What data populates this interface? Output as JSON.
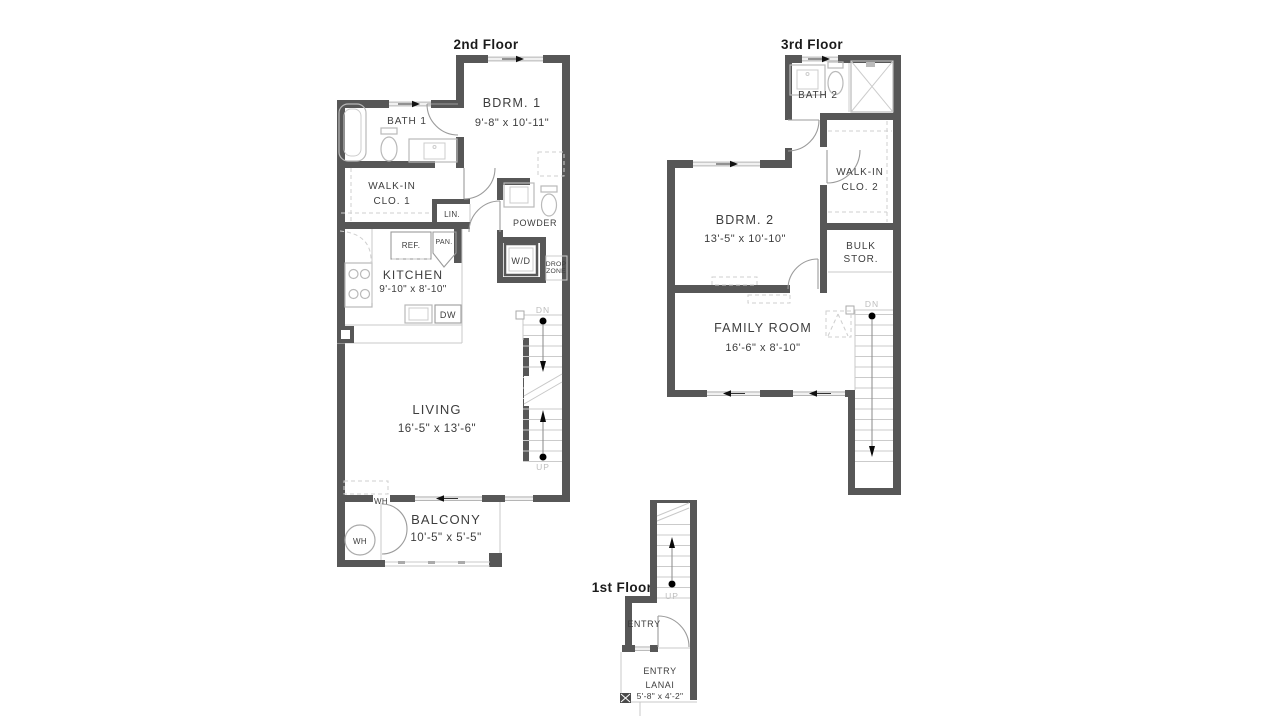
{
  "colors": {
    "wall": "#575757",
    "fixture_line": "#b9b9b9",
    "text": "#3d3d3d",
    "stair_text": "#bdbdbd"
  },
  "floors": {
    "second": {
      "title": "2nd Floor",
      "bdrm1": {
        "name": "BDRM. 1",
        "dims": "9'-8\" x 10'-11\""
      },
      "bath1": {
        "name": "BATH 1"
      },
      "walkin1": {
        "line1": "WALK-IN",
        "line2": "CLO. 1"
      },
      "lin": {
        "name": "LIN."
      },
      "powder": {
        "name": "POWDER"
      },
      "ref": {
        "name": "REF."
      },
      "pan": {
        "name": "PAN."
      },
      "wd": {
        "name": "W/D"
      },
      "dropzone": {
        "line1": "DROP",
        "line2": "ZONE"
      },
      "kitchen": {
        "name": "KITCHEN",
        "dims": "9'-10\" x 8'-10\""
      },
      "dw": {
        "name": "DW"
      },
      "living": {
        "name": "LIVING",
        "dims": "16'-5\" x 13'-6\""
      },
      "balcony": {
        "name": "BALCONY",
        "dims": "10'-5\" x 5'-5\""
      },
      "wh_wall": "WH",
      "wh_tank": "WH",
      "stair_dn": "DN",
      "stair_up": "UP"
    },
    "third": {
      "title": "3rd Floor",
      "bath2": {
        "name": "BATH 2"
      },
      "walkin2": {
        "line1": "WALK-IN",
        "line2": "CLO. 2"
      },
      "bdrm2": {
        "name": "BDRM. 2",
        "dims": "13'-5\" x 10'-10\""
      },
      "bulk": {
        "line1": "BULK",
        "line2": "STOR."
      },
      "family": {
        "name": "FAMILY ROOM",
        "dims": "16'-6\" x 8'-10\""
      },
      "stair_dn": "DN"
    },
    "first": {
      "title": "1st Floor",
      "entry": {
        "name": "ENTRY"
      },
      "lanai": {
        "line1": "ENTRY",
        "line2": "LANAI",
        "dims": "5'-8\" x 4'-2\""
      },
      "stair_up": "UP"
    }
  }
}
